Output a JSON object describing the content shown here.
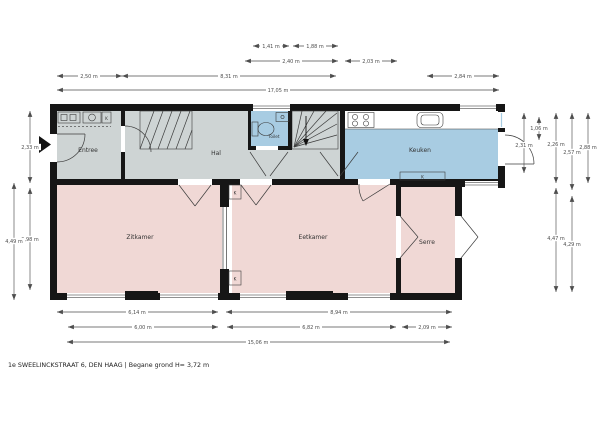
{
  "title_caption": "1e SWEELINCKSTRAAT 6, DEN HAAG | Begane grond H= 3,72 m",
  "rooms": {
    "entree": "Entree",
    "hal": "Hal",
    "toilet": "Toilet",
    "keuken": "Keuken",
    "zitkamer": "Zitkamer",
    "eetkamer": "Eetkamer",
    "serre": "Serre"
  },
  "labels": {
    "cabinet": "K"
  },
  "dims": {
    "t1a": "1,41 m",
    "t1b": "1,88 m",
    "t2a": "2,40 m",
    "t2b": "2,03 m",
    "t3a": "2,50 m",
    "t3b": "8,31 m",
    "t3c": "2,84 m",
    "t4": "17,05 m",
    "b1a": "6,14 m",
    "b1b": "8,94 m",
    "b2a": "6,00 m",
    "b2b": "6,82 m",
    "b2c": "2,09 m",
    "b3": "15,06 m",
    "l1": "2,33 m",
    "l2": "3,98 m",
    "l3": "4,49 m",
    "r1": "1,06 m",
    "r2": "2,31 m",
    "r3": "2,26 m",
    "r4": "2,57 m",
    "r5": "2,88 m",
    "r6": "4,47 m",
    "r7": "4,29 m"
  },
  "colors": {
    "background": "#ffffff",
    "hallway": "#ced4d4",
    "living": "#f0d8d5",
    "water": "#a8cce2",
    "wall": "#161616",
    "dimension": "#4d4d4d"
  }
}
